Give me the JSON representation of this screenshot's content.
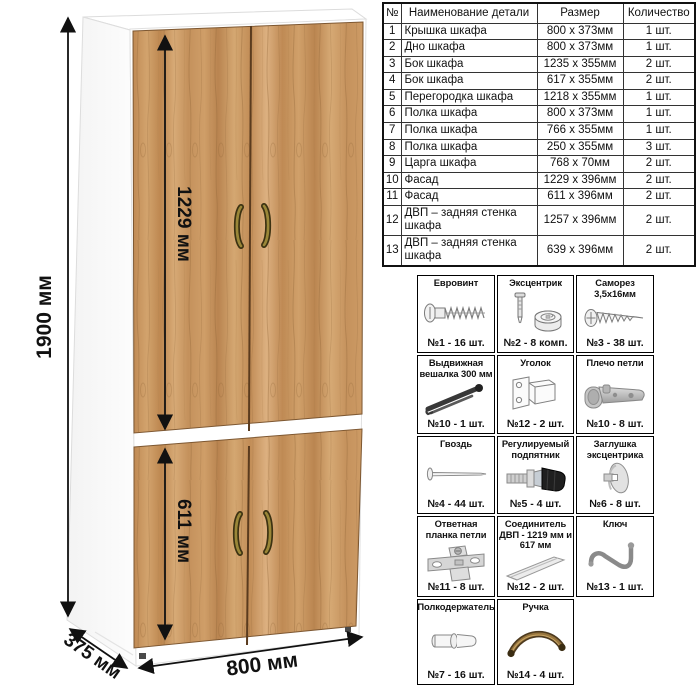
{
  "diagram": {
    "labels": {
      "height_total": "1900 мм",
      "upper_door_height": "1229 мм",
      "lower_door_height": "611 мм",
      "width": "800 мм",
      "depth": "375 мм"
    },
    "colors": {
      "wood": "#c99a63",
      "wood_grain": "#8f6437",
      "carcass": "#ffffff",
      "handle_bronze": "#9a8738",
      "dimension_line": "#111111"
    }
  },
  "parts_table": {
    "headers": [
      "№",
      "Наименование детали",
      "Размер",
      "Количество"
    ],
    "rows": [
      {
        "num": "1",
        "name": "Крышка шкафа",
        "size": "800 х 373мм",
        "qty": "1 шт."
      },
      {
        "num": "2",
        "name": "Дно шкафа",
        "size": "800 х 373мм",
        "qty": "1 шт."
      },
      {
        "num": "3",
        "name": "Бок шкафа",
        "size": "1235 х 355мм",
        "qty": "2 шт."
      },
      {
        "num": "4",
        "name": "Бок шкафа",
        "size": "617 х 355мм",
        "qty": "2 шт."
      },
      {
        "num": "5",
        "name": "Перегородка шкафа",
        "size": "1218 х 355мм",
        "qty": "1 шт."
      },
      {
        "num": "6",
        "name": "Полка шкафа",
        "size": "800 х 373мм",
        "qty": "1 шт."
      },
      {
        "num": "7",
        "name": "Полка шкафа",
        "size": "766 х 355мм",
        "qty": "1 шт."
      },
      {
        "num": "8",
        "name": "Полка шкафа",
        "size": "250 х 355мм",
        "qty": "3 шт."
      },
      {
        "num": "9",
        "name": "Царга шкафа",
        "size": "768 х 70мм",
        "qty": "2 шт."
      },
      {
        "num": "10",
        "name": "Фасад",
        "size": "1229 х 396мм",
        "qty": "2 шт."
      },
      {
        "num": "11",
        "name": "Фасад",
        "size": "611 х 396мм",
        "qty": "2 шт."
      },
      {
        "num": "12",
        "name": "ДВП – задняя стенка шкафа",
        "size": "1257 х 396мм",
        "qty": "2 шт."
      },
      {
        "num": "13",
        "name": "ДВП – задняя стенка шкафа",
        "size": "639 х 396мм",
        "qty": "2 шт."
      }
    ]
  },
  "hardware": {
    "items": [
      {
        "title": "Евровинт",
        "count": "№1 - 16 шт.",
        "icon": "euroscrew-icon"
      },
      {
        "title": "Эксцентрик",
        "count": "№2 - 8 комп.",
        "icon": "eccentric-cam-icon"
      },
      {
        "title": "Саморез 3,5х16мм",
        "count": "№3 - 38 шт.",
        "icon": "screw-icon"
      },
      {
        "title": "Выдвижная вешалка 300 мм",
        "count": "№10 - 1 шт.",
        "icon": "pullout-hanger-icon"
      },
      {
        "title": "Уголок",
        "count": "№12 - 2 шт.",
        "icon": "corner-bracket-icon"
      },
      {
        "title": "Плечо петли",
        "count": "№10 - 8 шт.",
        "icon": "hinge-arm-icon"
      },
      {
        "title": "Гвоздь",
        "count": "№4 - 44 шт.",
        "icon": "nail-icon"
      },
      {
        "title": "Регулируемый подпятник",
        "count": "№5 - 4 шт.",
        "icon": "adjustable-foot-icon"
      },
      {
        "title": "Заглушка эксцентрика",
        "count": "№6 - 8 шт.",
        "icon": "cam-cap-icon"
      },
      {
        "title": "Ответная планка петли",
        "count": "№11 - 8 шт.",
        "icon": "hinge-plate-icon"
      },
      {
        "title": "Соединитель ДВП - 1219 мм и 617 мм",
        "count": "№12 - 2 шт.",
        "icon": "hdf-connector-icon"
      },
      {
        "title": "Ключ",
        "count": "№13 - 1 шт.",
        "icon": "hex-key-icon"
      },
      {
        "title": "Полкодержатель",
        "count": "№7 - 16 шт.",
        "icon": "shelf-pin-icon"
      },
      {
        "title": "Ручка",
        "count": "№14 - 4 шт.",
        "icon": "handle-icon"
      }
    ]
  }
}
